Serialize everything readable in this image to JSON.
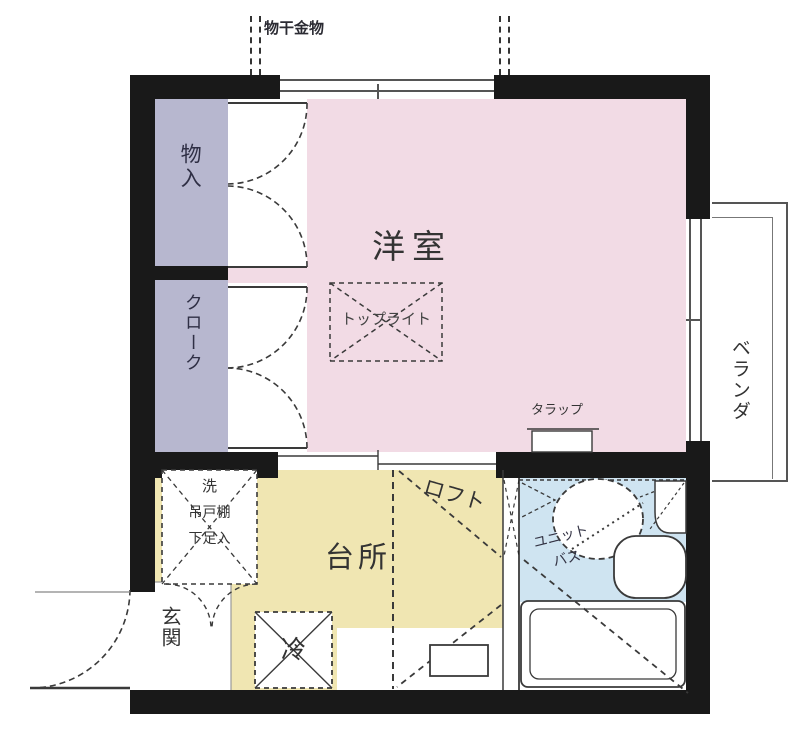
{
  "title": "apartment-floor-plan",
  "colors": {
    "western_room_pink": "#f2dbe5",
    "closet_lavender": "#b7b7cf",
    "kitchen_yellow": "#f0e6b2",
    "bath_blue": "#cfe4f1",
    "wall_black": "#191919"
  },
  "labels": {
    "laundry_hardware": "物干金物",
    "storage": "物入",
    "cloak": "クローク",
    "western_room": "洋室",
    "toplight": "トップライト",
    "veranda": "ベランダ",
    "ladder": "タラップ",
    "loft": "ロフト",
    "kitchen": "台所",
    "washer": "洗",
    "hanging_cupboard": "吊戸棚",
    "shoe_storage": "下足入",
    "unit_bath_line1": "ユニット",
    "unit_bath_line2": "バス",
    "entrance": "玄関",
    "refrigerator": "冷"
  }
}
